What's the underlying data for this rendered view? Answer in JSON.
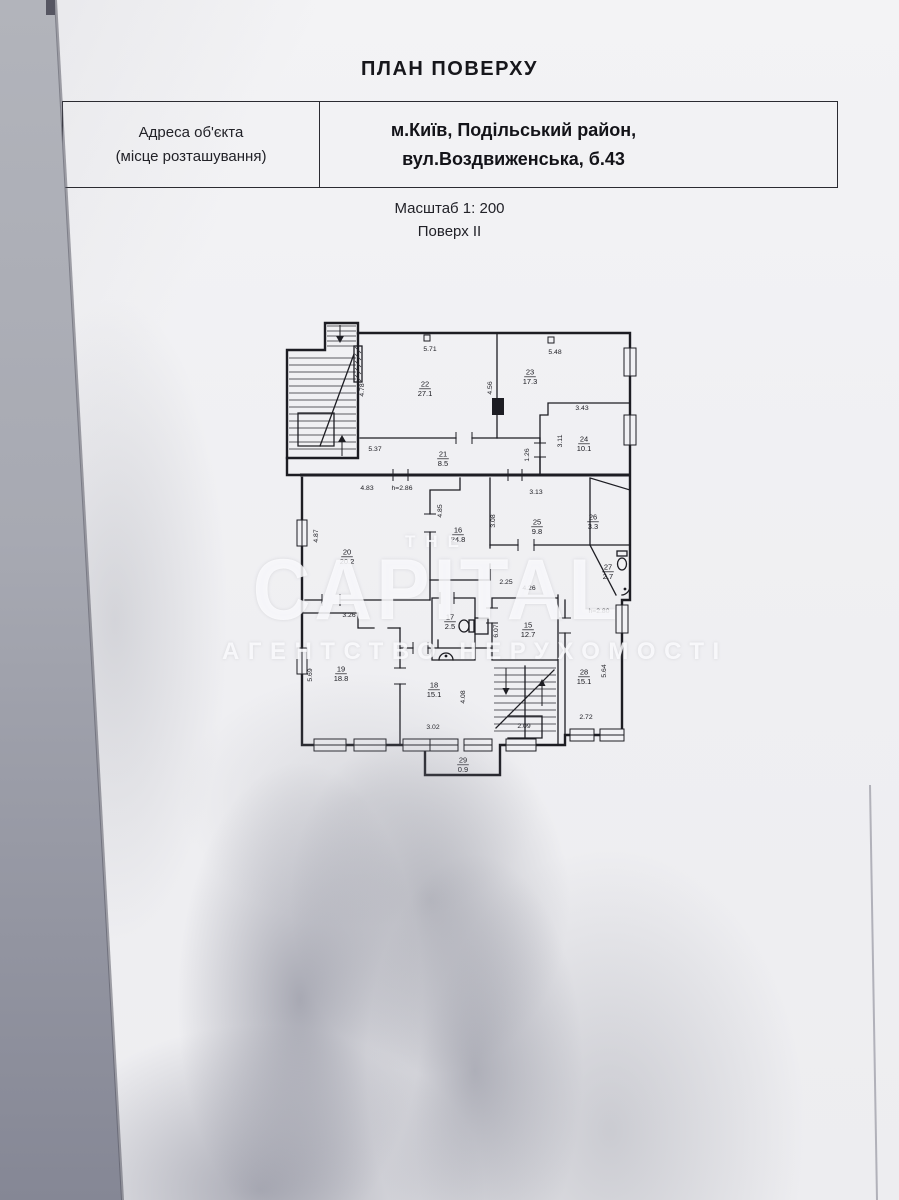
{
  "header": {
    "title": "ПЛАН ПОВЕРХУ",
    "address_label_line1": "Адреса об'єкта",
    "address_label_line2": "(місце розташування)",
    "address_value_line1": "м.Київ, Подільський район,",
    "address_value_line2": "вул.Воздвиженська, б.43",
    "scale": "Масштаб 1: 200",
    "floor": "Поверх II"
  },
  "watermark": {
    "the": "THE",
    "name": "CAPITAL",
    "subtitle": "АГЕНТСТВО НЕРУХОМОСТІ"
  },
  "colors": {
    "ink": "#1d1d23",
    "paper": "#f1f1f4",
    "watermark_white": "rgba(253,253,255,0.82)"
  },
  "plan": {
    "rooms": [
      {
        "num": "22",
        "area": "27.1",
        "x": 147,
        "y": 70
      },
      {
        "num": "23",
        "area": "17.3",
        "x": 252,
        "y": 58
      },
      {
        "num": "24",
        "area": "10.1",
        "x": 306,
        "y": 125
      },
      {
        "num": "21",
        "area": "8.5",
        "x": 165,
        "y": 140
      },
      {
        "num": "20",
        "area": "20.2",
        "x": 69,
        "y": 238
      },
      {
        "num": "16",
        "area": "24.8",
        "x": 180,
        "y": 216
      },
      {
        "num": "25",
        "area": "9.8",
        "x": 259,
        "y": 208
      },
      {
        "num": "26",
        "area": "3.3",
        "x": 315,
        "y": 203
      },
      {
        "num": "27",
        "area": "2.7",
        "x": 330,
        "y": 253
      },
      {
        "num": "17",
        "area": "2.5",
        "x": 172,
        "y": 303
      },
      {
        "num": "15",
        "area": "12.7",
        "x": 250,
        "y": 311
      },
      {
        "num": "19",
        "area": "18.8",
        "x": 63,
        "y": 355
      },
      {
        "num": "18",
        "area": "15.1",
        "x": 156,
        "y": 371
      },
      {
        "num": "28",
        "area": "15.1",
        "x": 306,
        "y": 358
      },
      {
        "num": "29",
        "area": "0.9",
        "x": 185,
        "y": 446
      }
    ],
    "dims": [
      {
        "t": "5.71",
        "x": 152,
        "y": 33,
        "r": 0
      },
      {
        "t": "5.48",
        "x": 277,
        "y": 36,
        "r": 0
      },
      {
        "t": "4.78",
        "x": 86,
        "y": 72,
        "r": -90
      },
      {
        "t": "4.56",
        "x": 214,
        "y": 70,
        "r": -90
      },
      {
        "t": "3.43",
        "x": 304,
        "y": 92,
        "r": 0
      },
      {
        "t": "3.11",
        "x": 284,
        "y": 123,
        "r": -90
      },
      {
        "t": "1.26",
        "x": 251,
        "y": 137,
        "r": -90
      },
      {
        "t": "5.37",
        "x": 97,
        "y": 133,
        "r": 0
      },
      {
        "t": "4.83",
        "x": 89,
        "y": 172,
        "r": 0
      },
      {
        "t": "h=2.86",
        "x": 124,
        "y": 172,
        "r": 0
      },
      {
        "t": "3.13",
        "x": 258,
        "y": 176,
        "r": 0
      },
      {
        "t": "3.08",
        "x": 217,
        "y": 203,
        "r": -90
      },
      {
        "t": "4.87",
        "x": 40,
        "y": 218,
        "r": -90
      },
      {
        "t": "4.85",
        "x": 164,
        "y": 193,
        "r": -90
      },
      {
        "t": "2.25",
        "x": 228,
        "y": 266,
        "r": 0
      },
      {
        "t": "4.26",
        "x": 251,
        "y": 272,
        "r": 0
      },
      {
        "t": "h=2.80",
        "x": 321,
        "y": 295,
        "r": 0
      },
      {
        "t": "3.26",
        "x": 71,
        "y": 299,
        "r": 0
      },
      {
        "t": "6.07",
        "x": 220,
        "y": 313,
        "r": -90
      },
      {
        "t": "5.69",
        "x": 34,
        "y": 357,
        "r": -90
      },
      {
        "t": "4.08",
        "x": 187,
        "y": 379,
        "r": -90
      },
      {
        "t": "5.64",
        "x": 328,
        "y": 353,
        "r": -90
      },
      {
        "t": "3.02",
        "x": 155,
        "y": 411,
        "r": 0
      },
      {
        "t": "2.09",
        "x": 246,
        "y": 410,
        "r": 0
      },
      {
        "t": "2.72",
        "x": 308,
        "y": 401,
        "r": 0
      }
    ]
  }
}
